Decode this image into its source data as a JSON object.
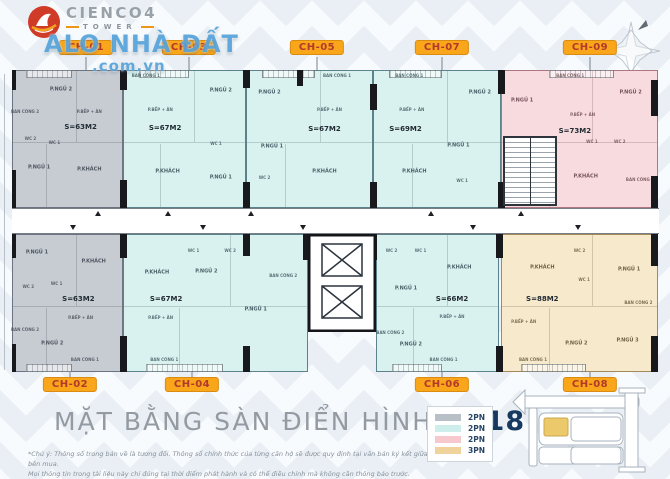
{
  "brand": {
    "name": "CIENCO4",
    "tower": "TOWER"
  },
  "watermark": {
    "line1": "ALO NHÀ ĐẤT",
    "line2": ".com.vn"
  },
  "title": {
    "main": "MẶT BẰNG SÀN ĐIỂN HÌNH",
    "sep": "|",
    "range": "2-18"
  },
  "footnote": {
    "line1": "*Chú ý: Thông số trong bản vẽ là tương đối. Thông số chính thức của từng căn hộ sẽ được quy định tại văn bản ký kết giữa bên bán và bên mua.",
    "line2": "Mọi thông tin trong tài liệu này chỉ đúng tại thời điểm phát hành và có thể điều chỉnh mà không cần thông báo trước."
  },
  "legend": [
    {
      "label": "2PN",
      "color": "#b9bfc6"
    },
    {
      "label": "2PN",
      "color": "#cdeeea"
    },
    {
      "label": "2PN",
      "color": "#f8c8cf"
    },
    {
      "label": "3PN",
      "color": "#f0d29c"
    }
  ],
  "colors": {
    "unit_gray": "#c7ccd3",
    "unit_teal": "#d9f1ef",
    "unit_pink": "#f8dbdf",
    "unit_tan": "#f7e9cc",
    "tag_bg": "#f9a61a",
    "tag_text": "#b2392b",
    "site_highlight": "#ecc96a"
  },
  "plan": {
    "units": [
      {
        "id": "CH-01",
        "row": "top",
        "scheme": "gray",
        "x": 12,
        "w": 111,
        "lx": 86,
        "area": "S=63M2",
        "ax": 62,
        "ay": 41,
        "rooms": [
          {
            "n": "P.NGỦ 2",
            "l": 44,
            "y": 14
          },
          {
            "n": "BAN CÔNG 2",
            "l": 11,
            "y": 30,
            "sm": true
          },
          {
            "n": "P.BẾP + ĂN",
            "l": 70,
            "y": 30,
            "sm": true
          },
          {
            "n": "WC 2",
            "l": 16,
            "y": 50,
            "sm": true
          },
          {
            "n": "WC 1",
            "l": 38,
            "y": 53,
            "sm": true
          },
          {
            "n": "P.NGỦ 1",
            "l": 24,
            "y": 71
          },
          {
            "n": "P.KHÁCH",
            "l": 70,
            "y": 73
          }
        ]
      },
      {
        "id": "CH-03",
        "row": "top",
        "scheme": "teal",
        "x": 123,
        "w": 123,
        "lx": 189,
        "area": "S=67M2",
        "ax": 34,
        "ay": 42,
        "rooms": [
          {
            "n": "BAN CÔNG 1",
            "l": 18,
            "y": 4,
            "sm": true
          },
          {
            "n": "P.BẾP + ĂN",
            "l": 30,
            "y": 29,
            "sm": true
          },
          {
            "n": "P.NGỦ 2",
            "l": 80,
            "y": 15
          },
          {
            "n": "WC 1",
            "l": 76,
            "y": 54,
            "sm": true
          },
          {
            "n": "P.KHÁCH",
            "l": 36,
            "y": 74
          },
          {
            "n": "P.NGỦ 1",
            "l": 80,
            "y": 79
          }
        ]
      },
      {
        "id": "CH-05",
        "row": "top",
        "scheme": "teal",
        "x": 246,
        "w": 127,
        "lx": 317,
        "area": "S=67M2",
        "ax": 62,
        "ay": 43,
        "rooms": [
          {
            "n": "P.NGỦ 2",
            "l": 18,
            "y": 16
          },
          {
            "n": "BAN CÔNG 1",
            "l": 72,
            "y": 4,
            "sm": true
          },
          {
            "n": "P.BẾP + ĂN",
            "l": 66,
            "y": 29,
            "sm": true
          },
          {
            "n": "P.NGỦ 1",
            "l": 20,
            "y": 56
          },
          {
            "n": "WC 2",
            "l": 14,
            "y": 79,
            "sm": true
          },
          {
            "n": "P.KHÁCH",
            "l": 62,
            "y": 74
          }
        ]
      },
      {
        "id": "CH-07",
        "row": "top",
        "scheme": "teal",
        "x": 373,
        "w": 128,
        "lx": 442,
        "area": "S=69M2",
        "ax": 25,
        "ay": 43,
        "rooms": [
          {
            "n": "BAN CÔNG 1",
            "l": 28,
            "y": 4,
            "sm": true
          },
          {
            "n": "P.BẾP + ĂN",
            "l": 30,
            "y": 29,
            "sm": true
          },
          {
            "n": "P.NGỦ 2",
            "l": 84,
            "y": 16
          },
          {
            "n": "P.NGỦ 1",
            "l": 67,
            "y": 55
          },
          {
            "n": "WC 1",
            "l": 70,
            "y": 81,
            "sm": true
          },
          {
            "n": "P.KHÁCH",
            "l": 32,
            "y": 74
          }
        ]
      },
      {
        "id": "CH-09",
        "row": "top",
        "scheme": "pink",
        "x": 501,
        "w": 157,
        "lx": 590,
        "area": "S=73M2",
        "ax": 47,
        "ay": 44,
        "rooms": [
          {
            "n": "BAN CÔNG 1",
            "l": 44,
            "y": 4,
            "sm": true
          },
          {
            "n": "P.NGỦ 1",
            "l": 13,
            "y": 22
          },
          {
            "n": "P.NGỦ 2",
            "l": 83,
            "y": 16
          },
          {
            "n": "P.BẾP + ĂN",
            "l": 52,
            "y": 32,
            "sm": true
          },
          {
            "n": "WC 1",
            "l": 58,
            "y": 52,
            "sm": true
          },
          {
            "n": "WC 2",
            "l": 76,
            "y": 52,
            "sm": true
          },
          {
            "n": "P.KHÁCH",
            "l": 54,
            "y": 78
          },
          {
            "n": "BAN CÔNG 2",
            "l": 89,
            "y": 80,
            "sm": true
          }
        ]
      },
      {
        "id": "CH-02",
        "row": "bottom",
        "scheme": "gray",
        "x": 12,
        "w": 111,
        "lx": 70,
        "area": "S=63M2",
        "ax": 60,
        "ay": 47,
        "rooms": [
          {
            "n": "P.NGỦ 1",
            "l": 22,
            "y": 13
          },
          {
            "n": "P.KHÁCH",
            "l": 74,
            "y": 20
          },
          {
            "n": "WC 2",
            "l": 14,
            "y": 38,
            "sm": true
          },
          {
            "n": "WC 1",
            "l": 40,
            "y": 36,
            "sm": true
          },
          {
            "n": "P.BẾP + ĂN",
            "l": 62,
            "y": 61,
            "sm": true
          },
          {
            "n": "BAN CÔNG 2",
            "l": 11,
            "y": 70,
            "sm": true
          },
          {
            "n": "P.NGỦ 2",
            "l": 36,
            "y": 80
          },
          {
            "n": "BAN CÔNG 1",
            "l": 66,
            "y": 92,
            "sm": true
          }
        ]
      },
      {
        "id": "CH-04",
        "row": "bottom",
        "scheme": "teal",
        "x": 123,
        "w": 185,
        "lx": 192,
        "area": "S=67M2",
        "ax": 23,
        "ay": 47,
        "rooms": [
          {
            "n": "WC 1",
            "l": 38,
            "y": 12,
            "sm": true
          },
          {
            "n": "WC 2",
            "l": 58,
            "y": 12,
            "sm": true
          },
          {
            "n": "P.KHÁCH",
            "l": 18,
            "y": 28
          },
          {
            "n": "P.NGỦ 2",
            "l": 45,
            "y": 27
          },
          {
            "n": "BAN CÔNG 2",
            "l": 87,
            "y": 30,
            "sm": true
          },
          {
            "n": "P.NGỦ 1",
            "l": 72,
            "y": 55
          },
          {
            "n": "P.BẾP + ĂN",
            "l": 20,
            "y": 61,
            "sm": true
          },
          {
            "n": "BAN CÔNG 1",
            "l": 22,
            "y": 92,
            "sm": true
          }
        ]
      },
      {
        "id": "CH-06",
        "row": "bottom",
        "scheme": "teal",
        "x": 376,
        "w": 123,
        "lx": 442,
        "area": "S=66M2",
        "ax": 62,
        "ay": 47,
        "rooms": [
          {
            "n": "WC 2",
            "l": 12,
            "y": 12,
            "sm": true
          },
          {
            "n": "WC 1",
            "l": 36,
            "y": 12,
            "sm": true
          },
          {
            "n": "P.KHÁCH",
            "l": 68,
            "y": 24
          },
          {
            "n": "P.NGỦ 1",
            "l": 24,
            "y": 40
          },
          {
            "n": "P.BẾP + ĂN",
            "l": 62,
            "y": 60,
            "sm": true
          },
          {
            "n": "BAN CÔNG 2",
            "l": 11,
            "y": 72,
            "sm": true
          },
          {
            "n": "P.NGỦ 2",
            "l": 28,
            "y": 81
          },
          {
            "n": "BAN CÔNG 1",
            "l": 55,
            "y": 92,
            "sm": true
          }
        ]
      },
      {
        "id": "CH-08",
        "row": "bottom",
        "scheme": "tan",
        "x": 501,
        "w": 157,
        "lx": 590,
        "area": "S=88M2",
        "ax": 26,
        "ay": 47,
        "rooms": [
          {
            "n": "P.KHÁCH",
            "l": 26,
            "y": 24
          },
          {
            "n": "WC 2",
            "l": 50,
            "y": 12,
            "sm": true
          },
          {
            "n": "WC 1",
            "l": 53,
            "y": 33,
            "sm": true
          },
          {
            "n": "P.NGỦ 1",
            "l": 82,
            "y": 26
          },
          {
            "n": "BAN CÔNG 2",
            "l": 88,
            "y": 50,
            "sm": true
          },
          {
            "n": "P.BẾP + ĂN",
            "l": 14,
            "y": 64,
            "sm": true
          },
          {
            "n": "P.NGỦ 2",
            "l": 48,
            "y": 80
          },
          {
            "n": "P.NGỦ 3",
            "l": 81,
            "y": 78
          },
          {
            "n": "BAN CÔNG 1",
            "l": 20,
            "y": 92,
            "sm": true
          }
        ]
      }
    ]
  }
}
